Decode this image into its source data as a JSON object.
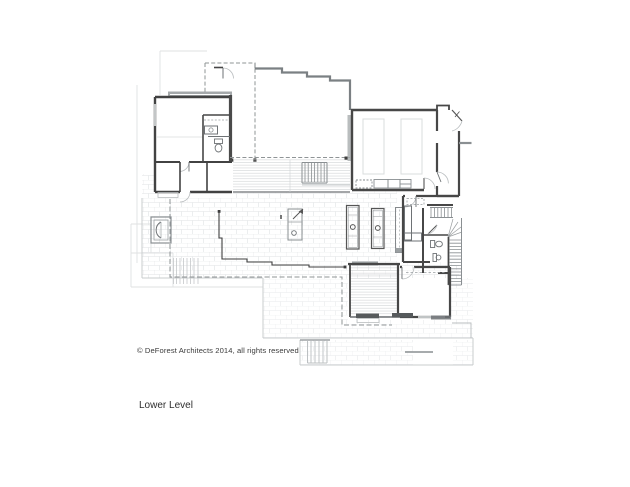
{
  "sheet": {
    "copyright": "© DeForest Architects 2014, all rights reserved",
    "level_label": "Lower Level"
  },
  "drawing": {
    "type": "architectural-floor-plan",
    "level": "Lower Level",
    "features": [
      "bedroom-suite",
      "bathroom",
      "mudroom",
      "entry-court",
      "covered-entry-roof",
      "stepped-site-wall",
      "garage",
      "parking-stalls",
      "garage-cabinets",
      "deck",
      "deck-stair",
      "stone-patio",
      "fire-pit",
      "outdoor-kitchen-islands",
      "grill",
      "laundry-room",
      "main-stair",
      "powder-room",
      "screened-porch",
      "lower-bedroom",
      "terrace-steps",
      "terrace-stair",
      "roof-overhang-outline"
    ],
    "colors": {
      "background": "#ffffff",
      "wall_dark": "#474747",
      "wall_medium": "#7b8083",
      "shade_gray": "#9ba0a2",
      "fixture_line": "#6e7275",
      "light_line": "#b9bdbf",
      "stone_joint": "#e0e2e4",
      "deck_board": "#cbced0",
      "dashed_line": "#8f9496",
      "faint_site_line": "#dfe1e2",
      "text": "#3a3a3a"
    }
  }
}
